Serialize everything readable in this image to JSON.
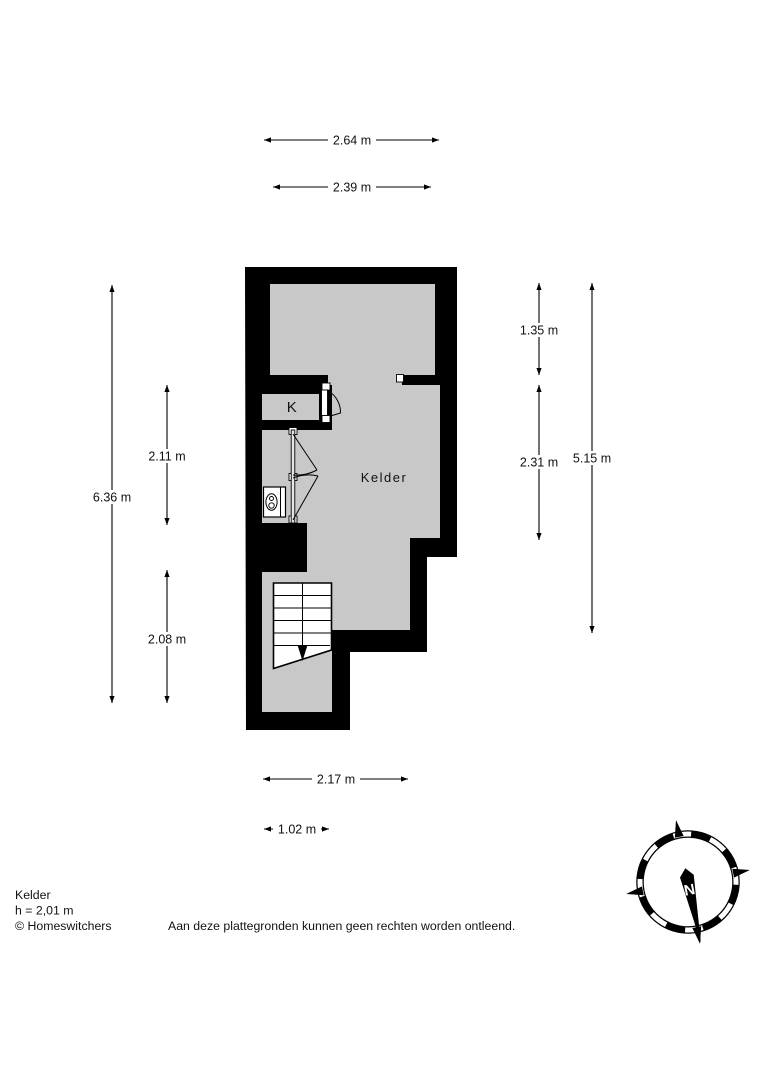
{
  "page": {
    "background": "#ffffff",
    "wall_color": "#000000",
    "room_fill": "#c8c8c8"
  },
  "floorplan": {
    "rooms": [
      {
        "id": "kelder",
        "label": "Kelder"
      },
      {
        "id": "k",
        "label": "K"
      }
    ],
    "dimensions": {
      "top": [
        {
          "label": "2.64 m"
        },
        {
          "label": "2.39 m"
        }
      ],
      "left": [
        {
          "label": "6.36 m"
        },
        {
          "label": "2.11 m"
        },
        {
          "label": "2.08 m"
        }
      ],
      "right": [
        {
          "label": "1.35 m"
        },
        {
          "label": "2.31 m"
        },
        {
          "label": "5.15 m"
        }
      ],
      "bottom": [
        {
          "label": "2.17 m"
        },
        {
          "label": "1.02 m"
        }
      ]
    },
    "compass": {
      "north_label": "N"
    }
  },
  "footer": {
    "room_name": "Kelder",
    "ceiling_height": "h = 2,01 m",
    "copyright": "© Homeswitchers",
    "disclaimer": "Aan deze plattegronden kunnen geen rechten worden ontleend."
  }
}
